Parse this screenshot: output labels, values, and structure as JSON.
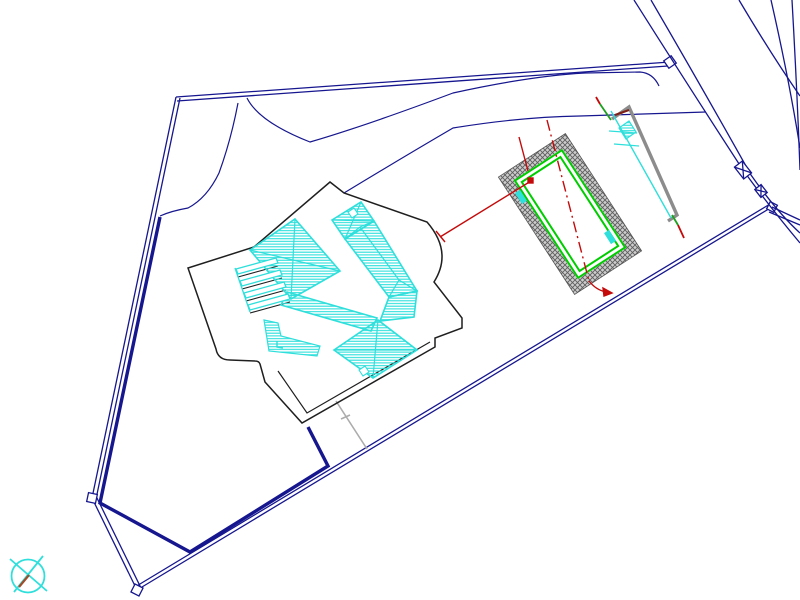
{
  "canvas": {
    "width_px": 800,
    "height_px": 600,
    "background": "#FFFFFF"
  },
  "drawing": {
    "type": "architectural-site-plan-cad",
    "elements": {
      "property_boundary": "polygonal parcel boundary, double navy line with corner markers",
      "road": "curved road with parallel navy edge lines at top right, with utility symbols",
      "house": "black terrace outline with cyan hatched hip roofs, pergola strips and stairs",
      "pool": "rotated rectangle with grey woven border hatch, double green edge, red centerlines",
      "retaining_wall": "grey wall with cyan drain line, ladder symbol and section markers",
      "tree_symbol": "crossed cyan circle at bottom left",
      "garden_wall": "thick navy fence line inside boundary",
      "path": "grey footpath from terrace to boundary"
    }
  },
  "colors": {
    "boundary_navy": "#16168F",
    "outline_black": "#1F1F1F",
    "roof_cyan": "#2EDFDB",
    "pool_hatch_line": "#5E5E5E",
    "pool_hatch_bg": "#CDCDCD",
    "pool_green": "#00CD00",
    "dimension_red": "#C40A0A",
    "wall_grey": "#8C8C8C",
    "wall_cap_darkred": "#7E2015",
    "marker_green": "#1FA01F",
    "path_grey": "#ACACAC",
    "trunk_brown": "#A14B28",
    "white": "#FFFFFF"
  }
}
